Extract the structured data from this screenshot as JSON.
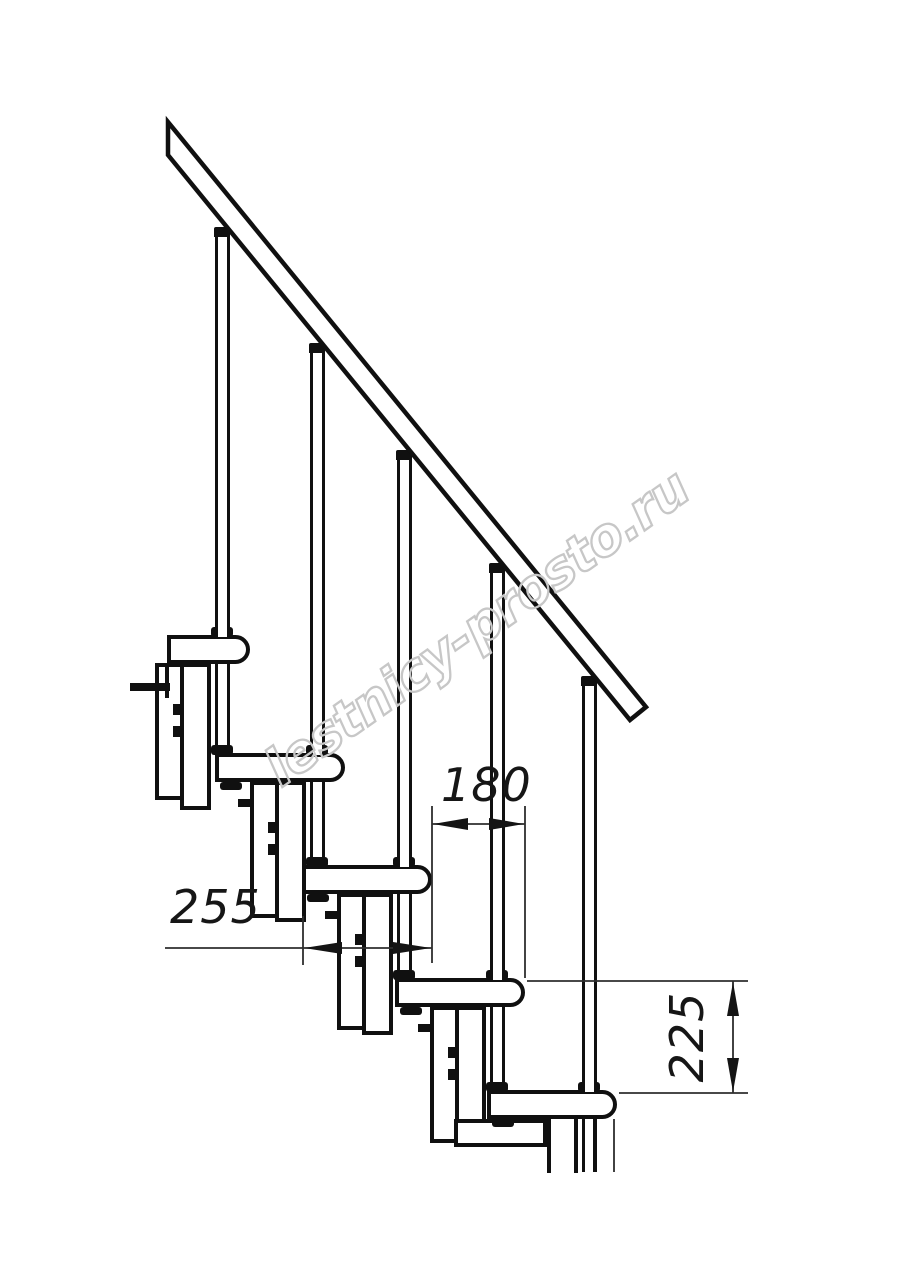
{
  "drawing": {
    "type": "staircase-side-view-technical-drawing",
    "watermark": "lestnicy-prosto.ru",
    "dimensions": {
      "tread_depth": "255",
      "step_run": "180",
      "step_rise": "225"
    },
    "colors": {
      "line": "#101010",
      "thin_line": "#2e2e2e",
      "watermark": "#c7c7c7",
      "background": "#ffffff"
    },
    "geometry": {
      "canvas": {
        "width": 914,
        "height": 1280
      },
      "steps": [
        {
          "front": 250,
          "top": 635
        },
        {
          "front": 345,
          "top": 753
        },
        {
          "front": 432,
          "top": 865
        },
        {
          "front": 525,
          "top": 978
        },
        {
          "front": 617,
          "top": 1090
        }
      ],
      "tread": {
        "length": 130,
        "thickness": 29,
        "first_left": 167
      },
      "baluster": {
        "width": 15,
        "offset_from_front": 28,
        "rail_slope": 1.222,
        "rail_intercept": -44
      },
      "module": {
        "pipe_width": 31,
        "box_width": 56,
        "box_depth": 137,
        "pipe_overshoot": 57
      },
      "rail_polygon": "168,122 168,155 630,720 646,707",
      "bottom_cut": 1173
    }
  }
}
